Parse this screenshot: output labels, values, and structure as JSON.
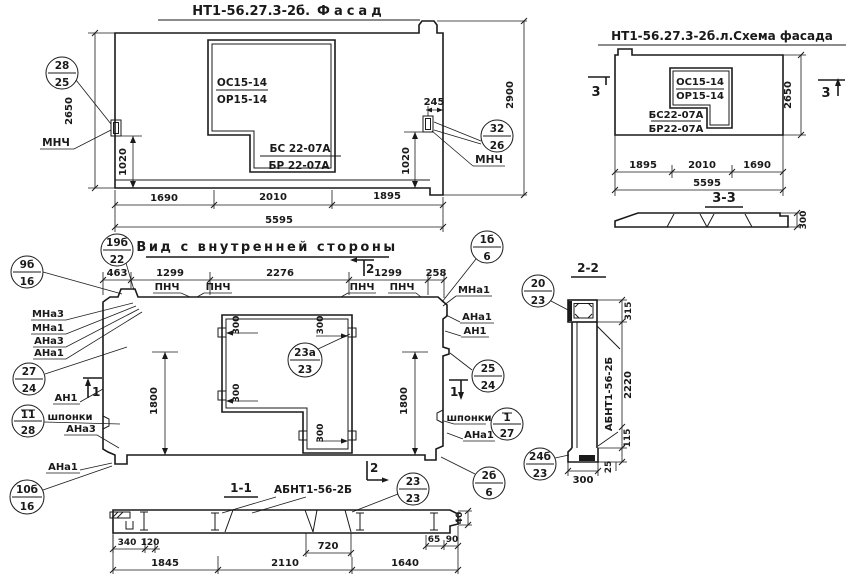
{
  "colors": {
    "ink": "#1a1a1a",
    "paper": "#ffffff"
  },
  "facade": {
    "title_code": "НТ1-56.27.3-2б.",
    "title_name": "Фасад",
    "window_mark_top": "ОС15-14",
    "window_mark_bot": "ОР15-14",
    "sill_mark_top": "БС 22-07А",
    "sill_mark_bot": "БР 22-07А",
    "anchor_label_left": "МНЧ",
    "anchor_label_right": "МНЧ",
    "dim_height": "2650",
    "dim_height_full": "2900",
    "dim_anchor_left": "1020",
    "dim_anchor_right": "1020",
    "dim_anchor_offset": "245",
    "dim_b1": "1690",
    "dim_b2": "2010",
    "dim_b3": "1895",
    "dim_total": "5595",
    "balloon_left": {
      "top": "28",
      "bot": "25"
    },
    "balloon_right": {
      "top": "32",
      "bot": "26"
    }
  },
  "scheme": {
    "title": "НТ1-56.27.3-2б.л.Схема фасада",
    "window_mark_top": "ОС15-14",
    "window_mark_bot": "ОР15-14",
    "sill_mark_top": "БС22-07А",
    "sill_mark_bot": "БР22-07А",
    "cut_mark": "3",
    "dim_height": "2650",
    "dim_b1": "1895",
    "dim_b2": "2010",
    "dim_b3": "1690",
    "dim_total": "5595",
    "section": {
      "title": "3-3",
      "dim_thickness": "300"
    }
  },
  "inner": {
    "title": "Вид с внутренней стороны",
    "dims_top": [
      "463",
      "1299",
      "2276",
      "1299",
      "258"
    ],
    "surface_label": "ПНЧ",
    "cut_mark_1": "1",
    "cut_mark_2": "2",
    "dim_height": "1800",
    "dim_tab": "300",
    "keys_label": "шпонки",
    "left_labels": {
      "l1": "МНа3",
      "l2": "МНа1",
      "l3": "АНа3",
      "l4": "АНа1",
      "l5": "АН1",
      "l6": "АНа3",
      "l7": "АНа1"
    },
    "right_labels": {
      "r1": "МНа1",
      "r2": "АНа1",
      "r3": "АН1",
      "r4": "АНа1"
    },
    "balloons": {
      "b19": {
        "top": "19б",
        "bot": "22"
      },
      "b9": {
        "top": "9б",
        "bot": "16"
      },
      "b27": {
        "top": "27",
        "bot": "24"
      },
      "b11": {
        "top": "11",
        "bot": "28"
      },
      "b10": {
        "top": "10б",
        "bot": "16"
      },
      "b1b": {
        "top": "1б",
        "bot": "6"
      },
      "b25": {
        "top": "25",
        "bot": "24"
      },
      "b1": {
        "top": "1",
        "bot": "27"
      },
      "b2b": {
        "top": "2б",
        "bot": "6"
      },
      "b23a": {
        "top": "23а",
        "bot": "23"
      }
    }
  },
  "section11": {
    "title": "1-1",
    "label": "АБНТ1-56-2Б",
    "balloon": {
      "top": "23",
      "bot": "23"
    },
    "dims": {
      "d340": "340",
      "d120": "120",
      "d720": "720",
      "d65": "65",
      "d90": "90",
      "d40": "40",
      "d1845": "1845",
      "d2110": "2110",
      "d1640": "1640"
    }
  },
  "section22": {
    "title": "2-2",
    "label": "АБНТ1-56-2Б",
    "balloon_top": {
      "top": "20",
      "bot": "23"
    },
    "balloon_bot": {
      "top": "24б",
      "bot": "23"
    },
    "dims": {
      "d315": "315",
      "d2220": "2220",
      "d115": "115",
      "d25": "25",
      "d300": "300"
    }
  }
}
